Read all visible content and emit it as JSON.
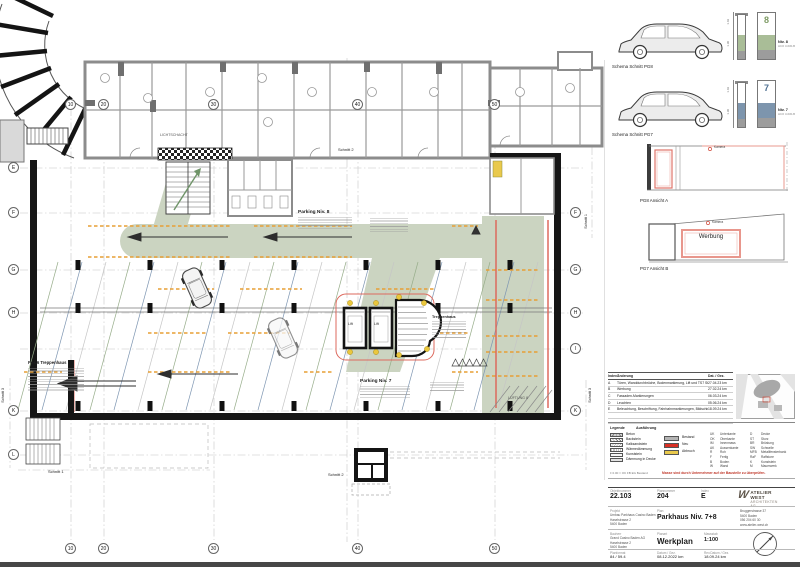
{
  "plan": {
    "grid_top": [
      "10",
      "20",
      "30",
      "40",
      "50"
    ],
    "grid_bottom": [
      "10",
      "20",
      "30",
      "40",
      "50"
    ],
    "grid_left": [
      "E",
      "F",
      "G",
      "H",
      "K",
      "L"
    ],
    "grid_right": [
      "F",
      "G",
      "H",
      "I",
      "K"
    ],
    "labels": {
      "parking8": "Parking Niv. 8",
      "parking7": "Parking Niv. 7",
      "lift": "Lift",
      "treppenhaus": "Treppenhaus",
      "pos6": "Pos.6 Treppenhaus",
      "lueftung": "LÜFTUNG 8",
      "lichtschacht": "LICHTSCHACHT",
      "schnitt1": "Schnitt 1",
      "schnitt2": "Schnitt 2",
      "schnitt3": "Schnitt 3"
    },
    "colors": {
      "walkway_green": "#cbd4c1",
      "marking_orange": "#e79f35",
      "new_red": "#dd6a5e",
      "bestand_gray": "#8c8c8c"
    }
  },
  "sidebar": {
    "schemas": [
      {
        "caption": "Schema Schnitt PG8",
        "level_digit": "8",
        "level_label": "Niv. 8",
        "level_code": "HCO 3-630-B",
        "dim_top": "1.02",
        "dim_bottom": "1.90"
      },
      {
        "caption": "Schema Schnitt PG7",
        "level_digit": "7",
        "level_label": "Niv. 7",
        "level_code": "HCO 3-630-B",
        "dim_top": "1.02",
        "dim_bottom": "1.90"
      }
    ],
    "elevations": [
      {
        "caption": "PG8 Ansicht A",
        "camera": "Kamera"
      },
      {
        "caption": "PG7 Ansicht B",
        "camera": "Kamera",
        "sign": "Werbung"
      }
    ],
    "revisions": {
      "headers": [
        "Index",
        "Änderung",
        "Dat. / Gez."
      ],
      "rows": [
        {
          "index": "A",
          "text": "Türen, Wanddurchbrüche, Bodenmarkierung, Lift und TS7 Stellen Baul.",
          "date": "27.04.23  km"
        },
        {
          "index": "B",
          "text": "Werbung",
          "date": "27.02.24  km"
        },
        {
          "index": "C",
          "text": "Fassaden-Markierungen",
          "date": "06.03.24  km"
        },
        {
          "index": "D",
          "text": "Leuchten",
          "date": "05.06.24  km"
        },
        {
          "index": "E",
          "text": "Beleuchtung, Beschriftung, Fahrbahnmarkierungen, Bildschirme",
          "date": "18.09.24  km"
        }
      ]
    },
    "legend": {
      "title": "Legende",
      "subtitle": "Ausführung",
      "materials": [
        "Beton",
        "Backstein",
        "Kalksandstein",
        "Wärmedämmung",
        "Kunststein",
        "Dämmung in Decke"
      ],
      "status": [
        {
          "label": "Bestand",
          "color": "#b4b4b4"
        },
        {
          "label": "Neu",
          "color": "#d93025"
        },
        {
          "label": "Abbruch",
          "color": "#e9c94c"
        }
      ],
      "abbr1": [
        {
          "k": "UK",
          "v": "Unterkante"
        },
        {
          "k": "OK",
          "v": "Oberkante"
        },
        {
          "k": "IM",
          "v": "Innenmass"
        },
        {
          "k": "AK",
          "v": "Aussenkante"
        },
        {
          "k": "R",
          "v": "Roh"
        },
        {
          "k": "F",
          "v": "Fertig"
        },
        {
          "k": "B",
          "v": "Boden"
        },
        {
          "k": "W",
          "v": "Wand"
        }
      ],
      "abbr2": [
        {
          "k": "D",
          "v": "Decke"
        },
        {
          "k": "ST",
          "v": "Sturz"
        },
        {
          "k": "BR",
          "v": "Brüstung"
        },
        {
          "k": "SW",
          "v": "Schwelle"
        },
        {
          "k": "MFB",
          "v": "Metallfensterbank"
        },
        {
          "k": "RaF",
          "v": "Raffstore"
        },
        {
          "k": "K",
          "v": "Kunststein"
        },
        {
          "k": "M",
          "v": "Mauerwerk"
        }
      ],
      "footnote": "± 0.00 = OK FB EG Bestand",
      "warning": "Masse sind durch Unternehmer auf der Baustelle zu überprüfen."
    },
    "titleblock": {
      "objekt_label": "Objektnummer",
      "objekt": "22.103",
      "plannr_label": "Plannummer",
      "plannr": "204",
      "index_label": "Index",
      "index": "E",
      "projekt_label": "Projekt",
      "projekt_lines": [
        "Umbau Parkhaus Casino Baden",
        "Haselstrasse 2",
        "5400 Baden"
      ],
      "plan_label": "Plan",
      "plan_title": "Parkhaus Niv. 7+8",
      "bauherr_label": "Bauherr",
      "bauherr_lines": [
        "Grand Casino Baden AG",
        "Haselstrasse 2",
        "5400 Baden"
      ],
      "planart_label": "Planart",
      "planart": "Werkplan",
      "massstab_label": "Massstab",
      "massstab": "1:100",
      "format_label": "Planformat",
      "format": "84 / 59.4",
      "datum_label": "Datum / Gez.",
      "datum": "08.12.2022  km",
      "rev_label": "Rev.Datum / Gez.",
      "rev": "18.09.24  km",
      "firm_name": "ATELIER WEST",
      "firm_sub": "ARCHITEKTEN AG",
      "firm_mark": "W",
      "firm_address": [
        "Bruggerstrasse 37",
        "5400 Baden",
        "056 204 60 30",
        "www.atelier-west.ch"
      ]
    }
  }
}
